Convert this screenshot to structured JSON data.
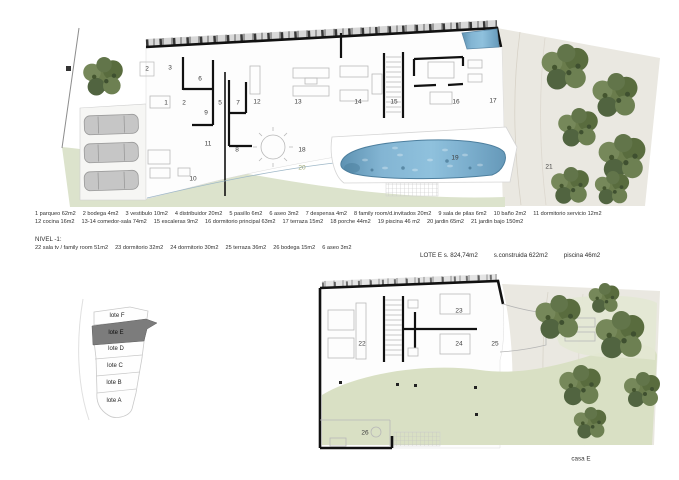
{
  "sheet": {
    "casa_label": "casa E"
  },
  "legend_level0": {
    "line1": [
      {
        "t": "1 parqueo 62m2"
      },
      {
        "t": "2 bodega 4m2"
      },
      {
        "t": "3 vestibulo 10m2"
      },
      {
        "t": "4 distribuidor 20m2"
      },
      {
        "t": "5 pasillo 6m2"
      },
      {
        "t": "6 aseo 3m2"
      },
      {
        "t": "7 despensa 4m2"
      },
      {
        "t": "8 family room/d.invitados 20m2"
      },
      {
        "t": "9 sala de pilas 6m2"
      },
      {
        "t": "10 baño 2m2"
      },
      {
        "t": "11 dormitorio servicio 12m2"
      }
    ],
    "line2": [
      {
        "t": "12 cocina 16m2"
      },
      {
        "t": "13-14 comedor-sala 74m2"
      },
      {
        "t": "15 escaleras 9m2"
      },
      {
        "t": "16 dormitorio principal 63m2"
      },
      {
        "t": "17 terraza 15m2"
      },
      {
        "t": "18 porche 44m2"
      },
      {
        "t": "19 piscina 46 m2"
      },
      {
        "t": "20 jardin 65m2"
      },
      {
        "t": "21 jardin bajo 150m2"
      }
    ]
  },
  "legend_level1": {
    "header": "NIVEL -1:",
    "line": [
      {
        "t": "22 sala tv / family room 51m2"
      },
      {
        "t": "23 dormitorio 32m2"
      },
      {
        "t": "24 dormitorio 30m2"
      },
      {
        "t": "25 terraza 36m2"
      },
      {
        "t": "26 bodega 15m2"
      },
      {
        "t": "6 aseo 3m2"
      }
    ]
  },
  "lot_summary": [
    {
      "t": "LOTE E  s. 824,74m2"
    },
    {
      "t": "s.construida 622m2"
    },
    {
      "t": "piscina 46m2"
    }
  ],
  "upper_plan": {
    "labels": [
      {
        "t": "2",
        "x": 147,
        "y": 69
      },
      {
        "t": "3",
        "x": 170,
        "y": 68
      },
      {
        "t": "6",
        "x": 200,
        "y": 79
      },
      {
        "t": "1",
        "x": 166,
        "y": 103
      },
      {
        "t": "2",
        "x": 184,
        "y": 103
      },
      {
        "t": "9",
        "x": 206,
        "y": 113
      },
      {
        "t": "5",
        "x": 220,
        "y": 103
      },
      {
        "t": "7",
        "x": 238,
        "y": 103
      },
      {
        "t": "12",
        "x": 257,
        "y": 102
      },
      {
        "t": "13",
        "x": 298,
        "y": 102
      },
      {
        "t": "14",
        "x": 358,
        "y": 102
      },
      {
        "t": "15",
        "x": 394,
        "y": 102
      },
      {
        "t": "16",
        "x": 456,
        "y": 102
      },
      {
        "t": "17",
        "x": 493,
        "y": 101
      },
      {
        "t": "11",
        "x": 208,
        "y": 144
      },
      {
        "t": "8",
        "x": 237,
        "y": 150
      },
      {
        "t": "18",
        "x": 302,
        "y": 150
      },
      {
        "t": "10",
        "x": 193,
        "y": 179
      },
      {
        "t": "20",
        "x": 302,
        "y": 168,
        "cls": "green"
      },
      {
        "t": "19",
        "x": 455,
        "y": 158
      },
      {
        "t": "21",
        "x": 549,
        "y": 167
      }
    ]
  },
  "lower_plan": {
    "labels": [
      {
        "t": "23",
        "x": 459,
        "y": 311
      },
      {
        "t": "22",
        "x": 362,
        "y": 344
      },
      {
        "t": "24",
        "x": 459,
        "y": 344
      },
      {
        "t": "25",
        "x": 495,
        "y": 344
      },
      {
        "t": "26",
        "x": 365,
        "y": 433
      }
    ]
  },
  "lot_map": {
    "items": [
      {
        "t": "lote F",
        "x": 117,
        "y": 316
      },
      {
        "t": "lote E",
        "x": 116,
        "y": 333,
        "cls": "selected"
      },
      {
        "t": "lote D",
        "x": 116,
        "y": 349
      },
      {
        "t": "lote C",
        "x": 115,
        "y": 366
      },
      {
        "t": "lote B",
        "x": 114,
        "y": 383
      },
      {
        "t": "lote A",
        "x": 114,
        "y": 401
      }
    ]
  },
  "colors": {
    "terrain": "#eae8e1",
    "garden": "#dce3cc",
    "garden_lower": "#d9e0c4",
    "pool": "#82b4d2",
    "pool_dark": "#4d7f9e",
    "wall": "#111111",
    "tree": "#66784a",
    "lot_selected": "#7c7c7c"
  }
}
